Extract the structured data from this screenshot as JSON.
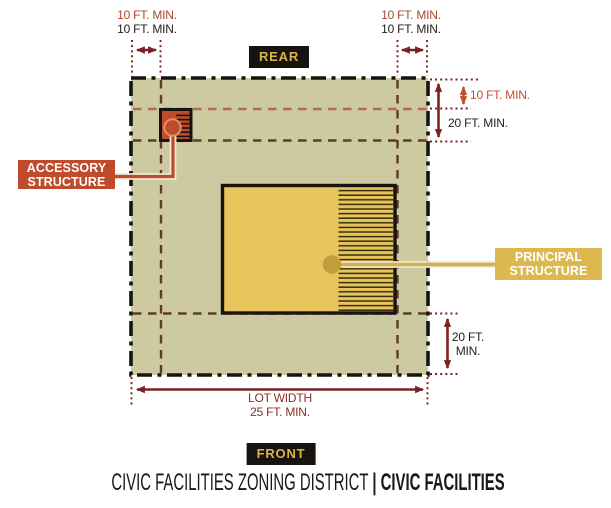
{
  "colors": {
    "lot-fill": "#cdcaa1",
    "ink": "#171310",
    "brick": "#bf4a2c",
    "brick-light": "#df8f6b",
    "gold": "#e7c45c",
    "gold-badge": "#dcb84e",
    "gold-dark": "#c29e3c",
    "gold-line": "#d4b24a",
    "maroon": "#7b2125",
    "orange": "#c1512e",
    "dash-light": "#b26a4c",
    "dash-dark": "#5f3b27",
    "dim-red": "#ad462b",
    "lotwidth-red": "#8a2f26",
    "badge-text": "#d9b545",
    "halo": "#f0e9d6"
  },
  "badges": {
    "rear": "REAR",
    "front": "FRONT"
  },
  "dims": {
    "rear_left_line1": "10 FT. MIN.",
    "rear_left_line2": "10 FT. MIN.",
    "rear_right_line1": "10 FT. MIN.",
    "rear_right_line2": "10 FT. MIN.",
    "side_accessory": "10 FT. MIN.",
    "side_principal": "20 FT. MIN.",
    "front_line1": "20 FT.",
    "front_line2": "MIN.",
    "lot_width_line1": "LOT WIDTH",
    "lot_width_line2": "25 FT. MIN."
  },
  "structures": {
    "accessory_line1": "ACCESSORY",
    "accessory_line2": "STRUCTURE",
    "principal_line1": "PRINCIPAL",
    "principal_line2": "STRUCTURE"
  },
  "caption": {
    "district": "CIVIC FACILITIES ZONING DISTRICT",
    "separator": "|",
    "zone": "CIVIC FACILITIES"
  }
}
